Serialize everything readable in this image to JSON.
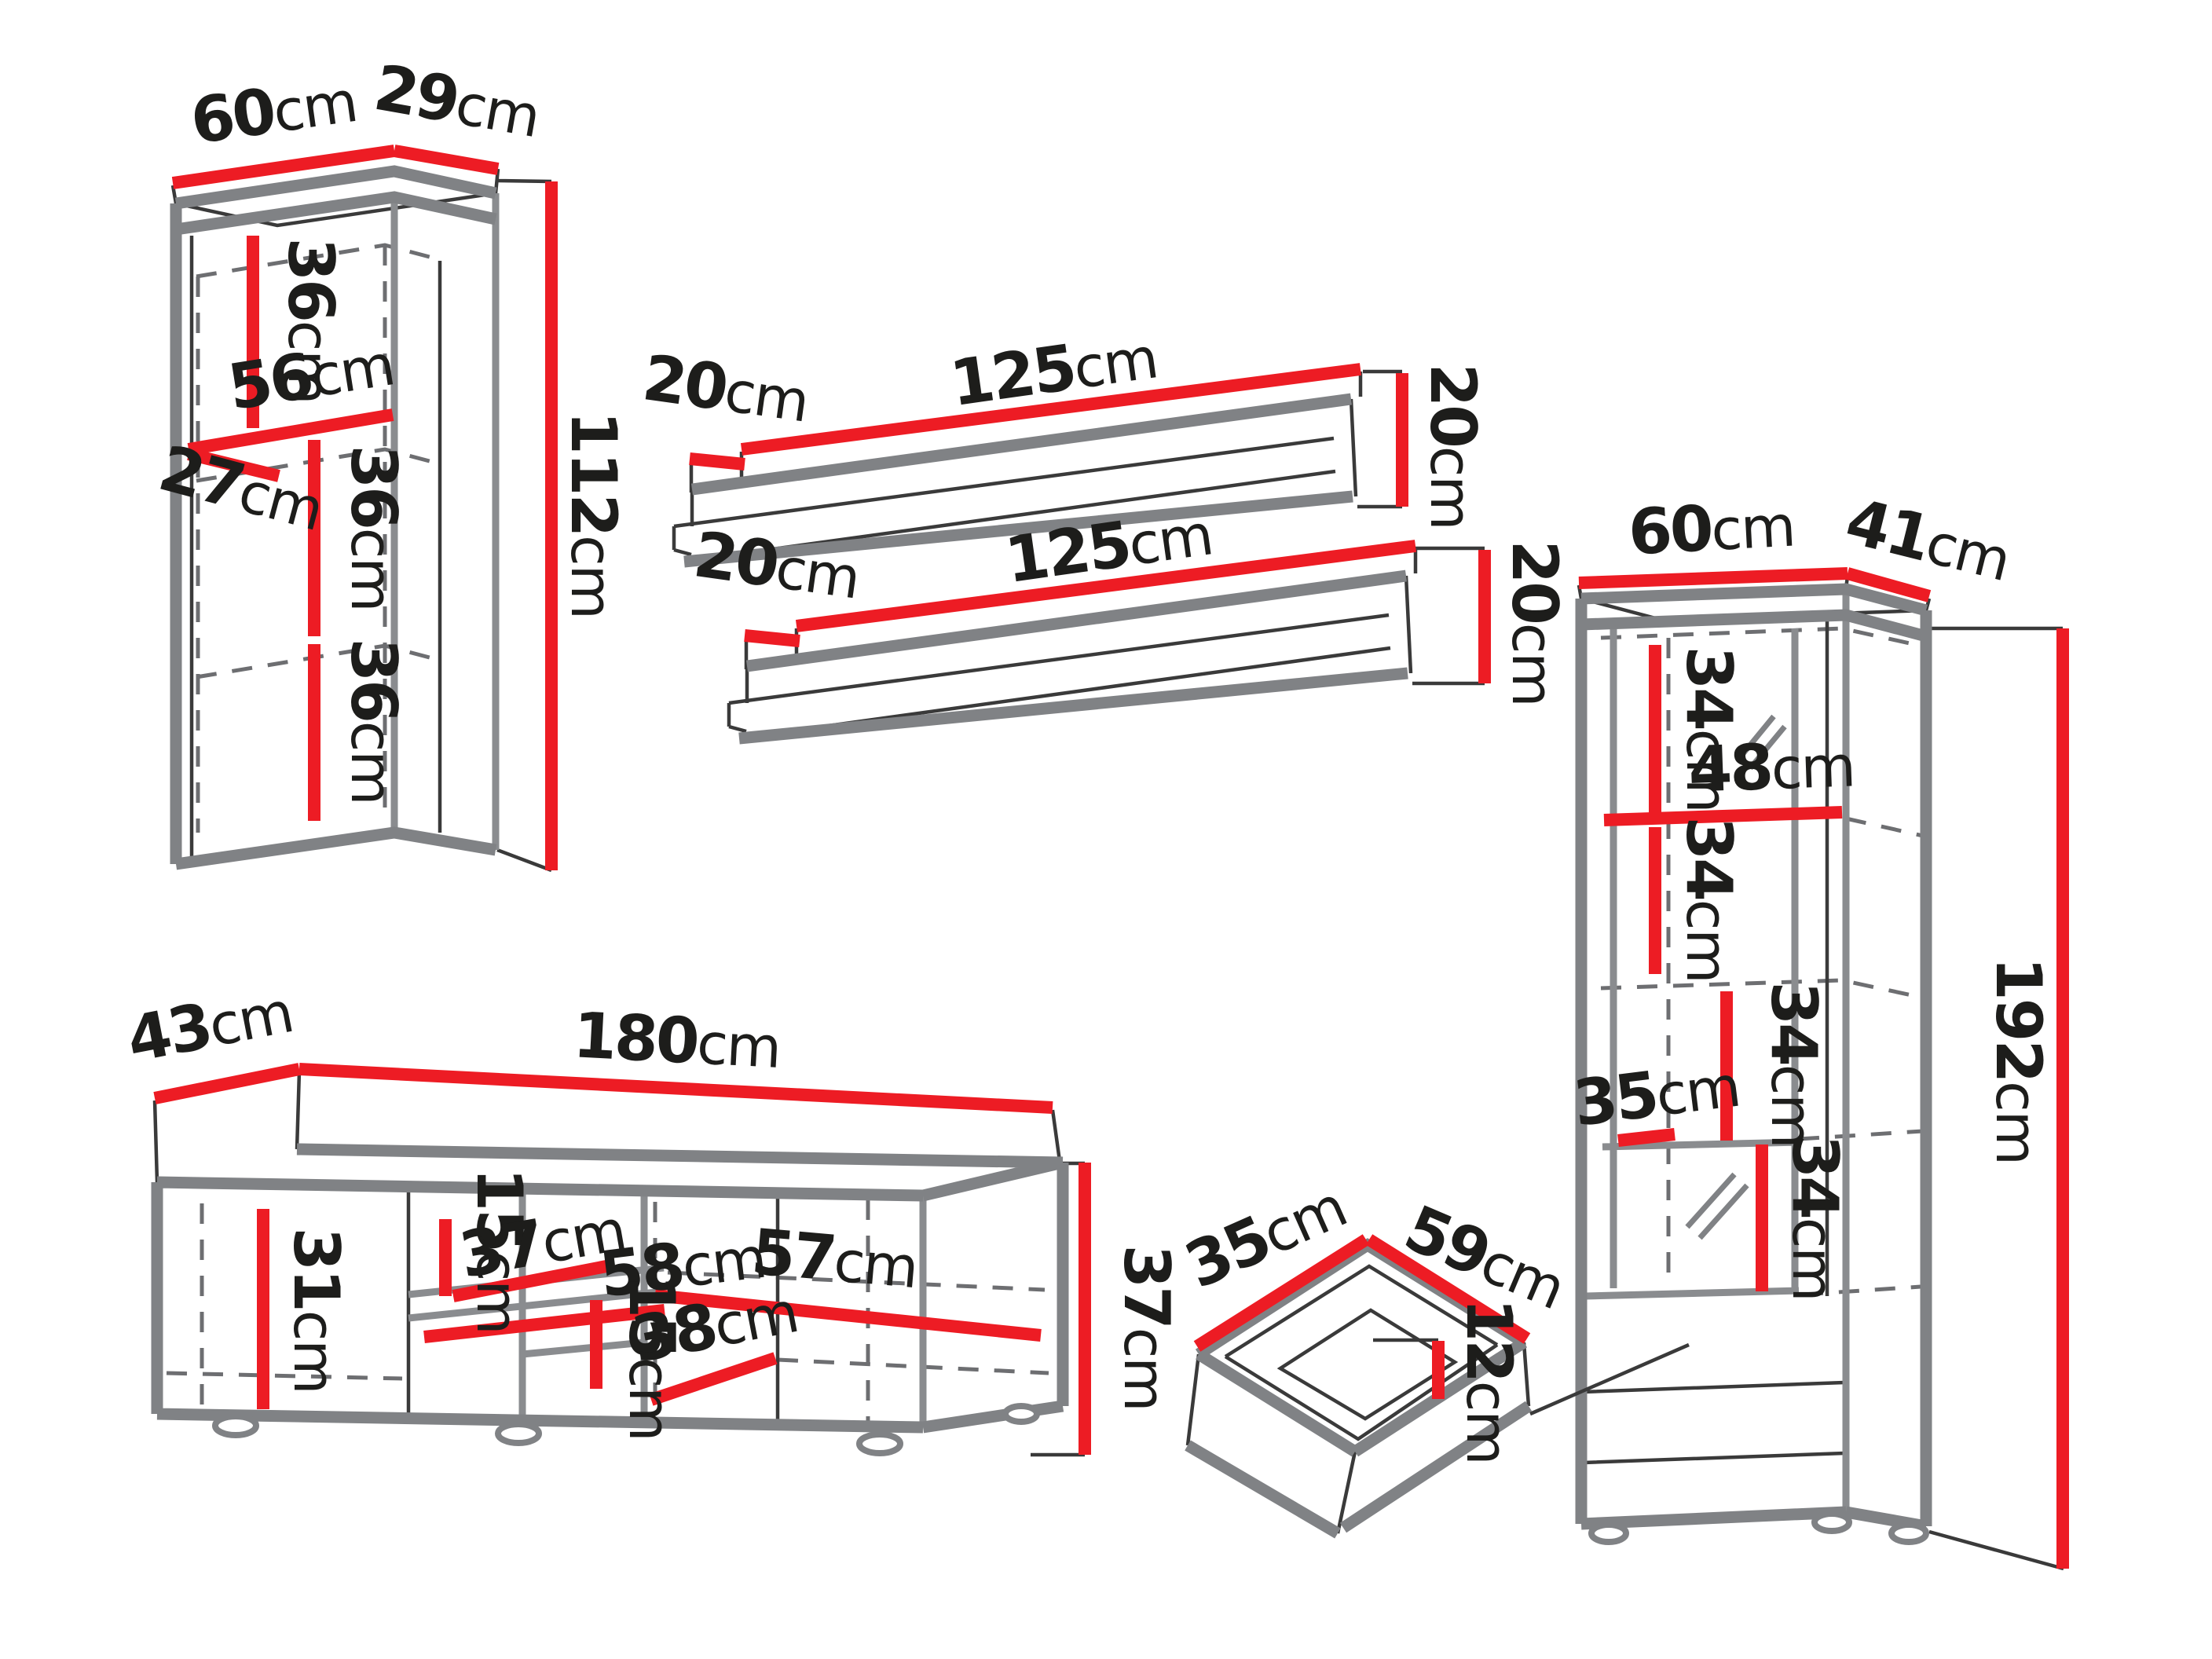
{
  "colors": {
    "dimension_line_red": "#ed1c24",
    "furniture_outline_gray": "#808285",
    "label_text_black": "#1d1d1b",
    "background": "#ffffff"
  },
  "pieces": {
    "wall_cabinet": {
      "dims": {
        "width": {
          "value": "60",
          "unit": "cm"
        },
        "depth": {
          "value": "29",
          "unit": "cm"
        },
        "height": {
          "value": "112",
          "unit": "cm"
        },
        "top_section": {
          "value": "36",
          "unit": "cm"
        },
        "shelf_width": {
          "value": "56",
          "unit": "cm"
        },
        "inner_depth": {
          "value": "27",
          "unit": "cm"
        },
        "middle_section": {
          "value": "36",
          "unit": "cm"
        },
        "bottom_section": {
          "value": "36",
          "unit": "cm"
        }
      }
    },
    "shelf_upper": {
      "dims": {
        "width": {
          "value": "125",
          "unit": "cm"
        },
        "depth": {
          "value": "20",
          "unit": "cm"
        },
        "height": {
          "value": "20",
          "unit": "cm"
        }
      }
    },
    "shelf_lower": {
      "dims": {
        "width": {
          "value": "125",
          "unit": "cm"
        },
        "depth": {
          "value": "20",
          "unit": "cm"
        },
        "height": {
          "value": "20",
          "unit": "cm"
        }
      }
    },
    "tv_stand": {
      "dims": {
        "depth": {
          "value": "43",
          "unit": "cm"
        },
        "width": {
          "value": "180",
          "unit": "cm"
        },
        "height": {
          "value": "37",
          "unit": "cm"
        },
        "left_section_height": {
          "value": "31",
          "unit": "cm"
        },
        "top_niche_height": {
          "value": "15",
          "unit": "cm"
        },
        "shelf_depth": {
          "value": "37",
          "unit": "cm"
        },
        "shelf_width": {
          "value": "58",
          "unit": "cm"
        },
        "right_shelf_width": {
          "value": "57",
          "unit": "cm"
        },
        "bottom_niche_height": {
          "value": "15",
          "unit": "cm"
        },
        "bottom_width": {
          "value": "38",
          "unit": "cm"
        }
      }
    },
    "display_cabinet": {
      "dims": {
        "width": {
          "value": "60",
          "unit": "cm"
        },
        "depth": {
          "value": "41",
          "unit": "cm"
        },
        "height": {
          "value": "192",
          "unit": "cm"
        },
        "section_1": {
          "value": "34",
          "unit": "cm"
        },
        "shelf_width": {
          "value": "48",
          "unit": "cm"
        },
        "section_2": {
          "value": "34",
          "unit": "cm"
        },
        "section_3": {
          "value": "34",
          "unit": "cm"
        },
        "inner_depth": {
          "value": "35",
          "unit": "cm"
        },
        "section_4": {
          "value": "34",
          "unit": "cm"
        }
      }
    },
    "drawer": {
      "dims": {
        "depth": {
          "value": "35",
          "unit": "cm"
        },
        "width": {
          "value": "59",
          "unit": "cm"
        },
        "height": {
          "value": "12",
          "unit": "cm"
        }
      }
    }
  }
}
